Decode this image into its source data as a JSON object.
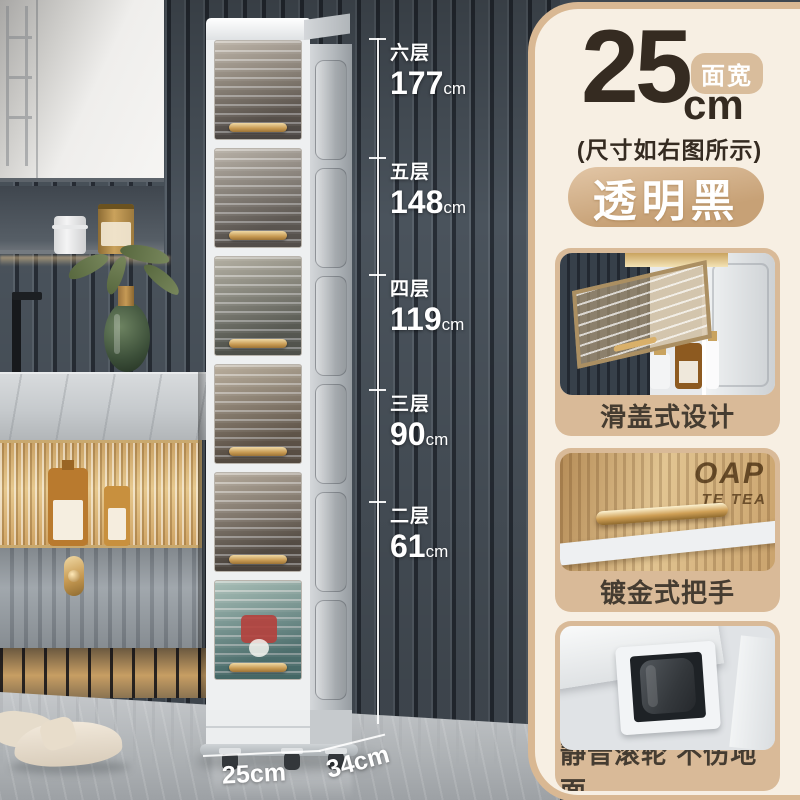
{
  "scene": {
    "dimensions": [
      {
        "tier": "六层",
        "value": "177",
        "unit": "cm"
      },
      {
        "tier": "五层",
        "value": "148",
        "unit": "cm"
      },
      {
        "tier": "四层",
        "value": "119",
        "unit": "cm"
      },
      {
        "tier": "三层",
        "value": "90",
        "unit": "cm"
      },
      {
        "tier": "二层",
        "value": "61",
        "unit": "cm"
      }
    ],
    "floor_width": "25cm",
    "floor_depth": "34cm"
  },
  "panel": {
    "width_value": "25",
    "width_unit": "cm",
    "width_badge": "面宽",
    "size_note": "(尺寸如右图所示)",
    "color_name": "透明黑",
    "features": [
      {
        "caption": "滑盖式设计"
      },
      {
        "caption": "镀金式把手",
        "overlay_text_1": "OAP",
        "overlay_text_2": "TE TEA"
      },
      {
        "caption": "静音滚轮 不伤地面"
      }
    ]
  },
  "colors": {
    "panel_bg": "#f7efe3",
    "panel_border": "#d9b893",
    "badge_bg": "#d9bd9c",
    "banner_gradient_start": "#e2c6a6",
    "banner_gradient_end": "#c7a176",
    "text_dark": "#352b21",
    "caption_text": "#453c31",
    "accent_gold": "#c9a35f",
    "dimension_text": "#ffffff",
    "wall_slat": "#4a535c",
    "bottom_door_teal": "#679490"
  }
}
